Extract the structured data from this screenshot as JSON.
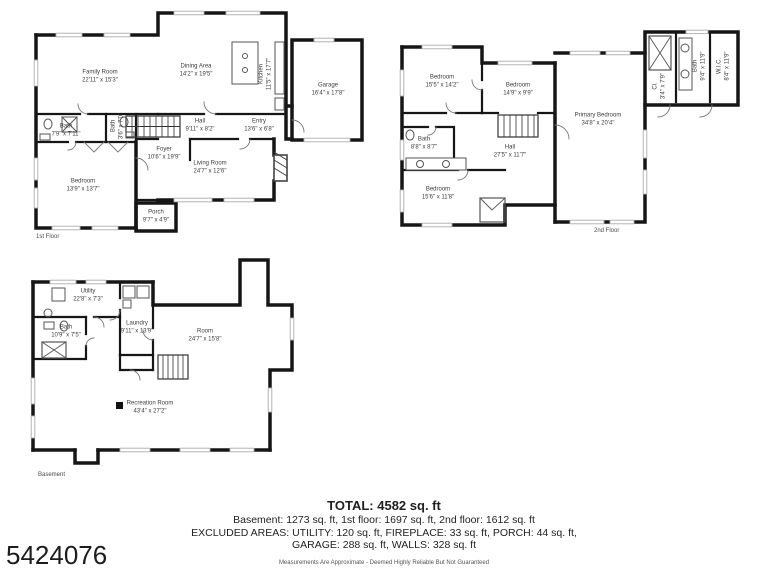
{
  "listing": {
    "number": "5424076"
  },
  "colors": {
    "walls": "#161616",
    "background": "#ffffff",
    "text": "#3d3d3d",
    "window": "#adadad"
  },
  "floors": {
    "first": {
      "caption": "1st Floor",
      "rooms": {
        "family_room": {
          "name": "Family Room",
          "dims": "22'11\" x 15'3\""
        },
        "dining_area": {
          "name": "Dining Area",
          "dims": "14'2\" x 19'5\""
        },
        "kitchen": {
          "name": "Kitchen",
          "dims": "11'5\" x 17'7\""
        },
        "garage": {
          "name": "Garage",
          "dims": "16'4\" x 17'8\""
        },
        "hall": {
          "name": "Hall",
          "dims": "9'11\" x 8'2\""
        },
        "entry": {
          "name": "Entry",
          "dims": "13'6\" x 6'8\""
        },
        "foyer": {
          "name": "Foyer",
          "dims": "10'6\" x 19'9\""
        },
        "living_room": {
          "name": "Living Room",
          "dims": "24'7\" x 12'6\""
        },
        "bedroom": {
          "name": "Bedroom",
          "dims": "13'9\" x 13'7\""
        },
        "bath": {
          "name": "Bath",
          "dims": "7'9\" x 7'11\""
        },
        "bath_small": {
          "name": "Bath",
          "dims": "3'6\" x 7'0\""
        },
        "porch": {
          "name": "Porch",
          "dims": "9'7\" x 4'9\""
        }
      }
    },
    "second": {
      "caption": "2nd Floor",
      "rooms": {
        "bedroom_1": {
          "name": "Bedroom",
          "dims": "15'5\" x 14'2\""
        },
        "bedroom_2": {
          "name": "Bedroom",
          "dims": "14'9\" x 9'9\""
        },
        "bedroom_3": {
          "name": "Bedroom",
          "dims": "15'6\" x 11'8\""
        },
        "primary_bedroom": {
          "name": "Primary Bedroom",
          "dims": "34'8\" x 20'4\""
        },
        "hall": {
          "name": "Hall",
          "dims": "27'5\" x 11'7\""
        },
        "bath": {
          "name": "Bath",
          "dims": "8'8\" x 8'7\""
        },
        "bath_upper": {
          "name": "Bath",
          "dims": "9'4\" x 11'9\""
        },
        "wic": {
          "name": "W.I.C.",
          "dims": "8'4\" x 11'9\""
        },
        "closet": {
          "name": "Cl.",
          "dims": "3'4\" x 7'9\""
        }
      }
    },
    "basement": {
      "caption": "Basement",
      "rooms": {
        "utility": {
          "name": "Utility",
          "dims": "22'8\" x 7'3\""
        },
        "bath": {
          "name": "Bath",
          "dims": "10'9\" x 7'5\""
        },
        "laundry": {
          "name": "Laundry",
          "dims": "9'11\" x 13'9\""
        },
        "room": {
          "name": "Room",
          "dims": "24'7\" x 15'8\""
        },
        "recreation_room": {
          "name": "Recreation Room",
          "dims": "43'4\" x 27'2\""
        }
      }
    }
  },
  "summary": {
    "total": "TOTAL: 4582 sq. ft",
    "floors_line": "Basement: 1273 sq. ft, 1st floor: 1697 sq. ft, 2nd floor: 1612 sq. ft",
    "excluded_line_1": "EXCLUDED AREAS: UTILITY: 120 sq. ft, FIREPLACE: 33 sq. ft, PORCH: 44 sq. ft,",
    "excluded_line_2": "GARAGE: 288 sq. ft, WALLS: 328 sq. ft",
    "disclaimer": "Measurements Are Approximate - Deemed Highly Reliable But Not Guaranteed"
  }
}
